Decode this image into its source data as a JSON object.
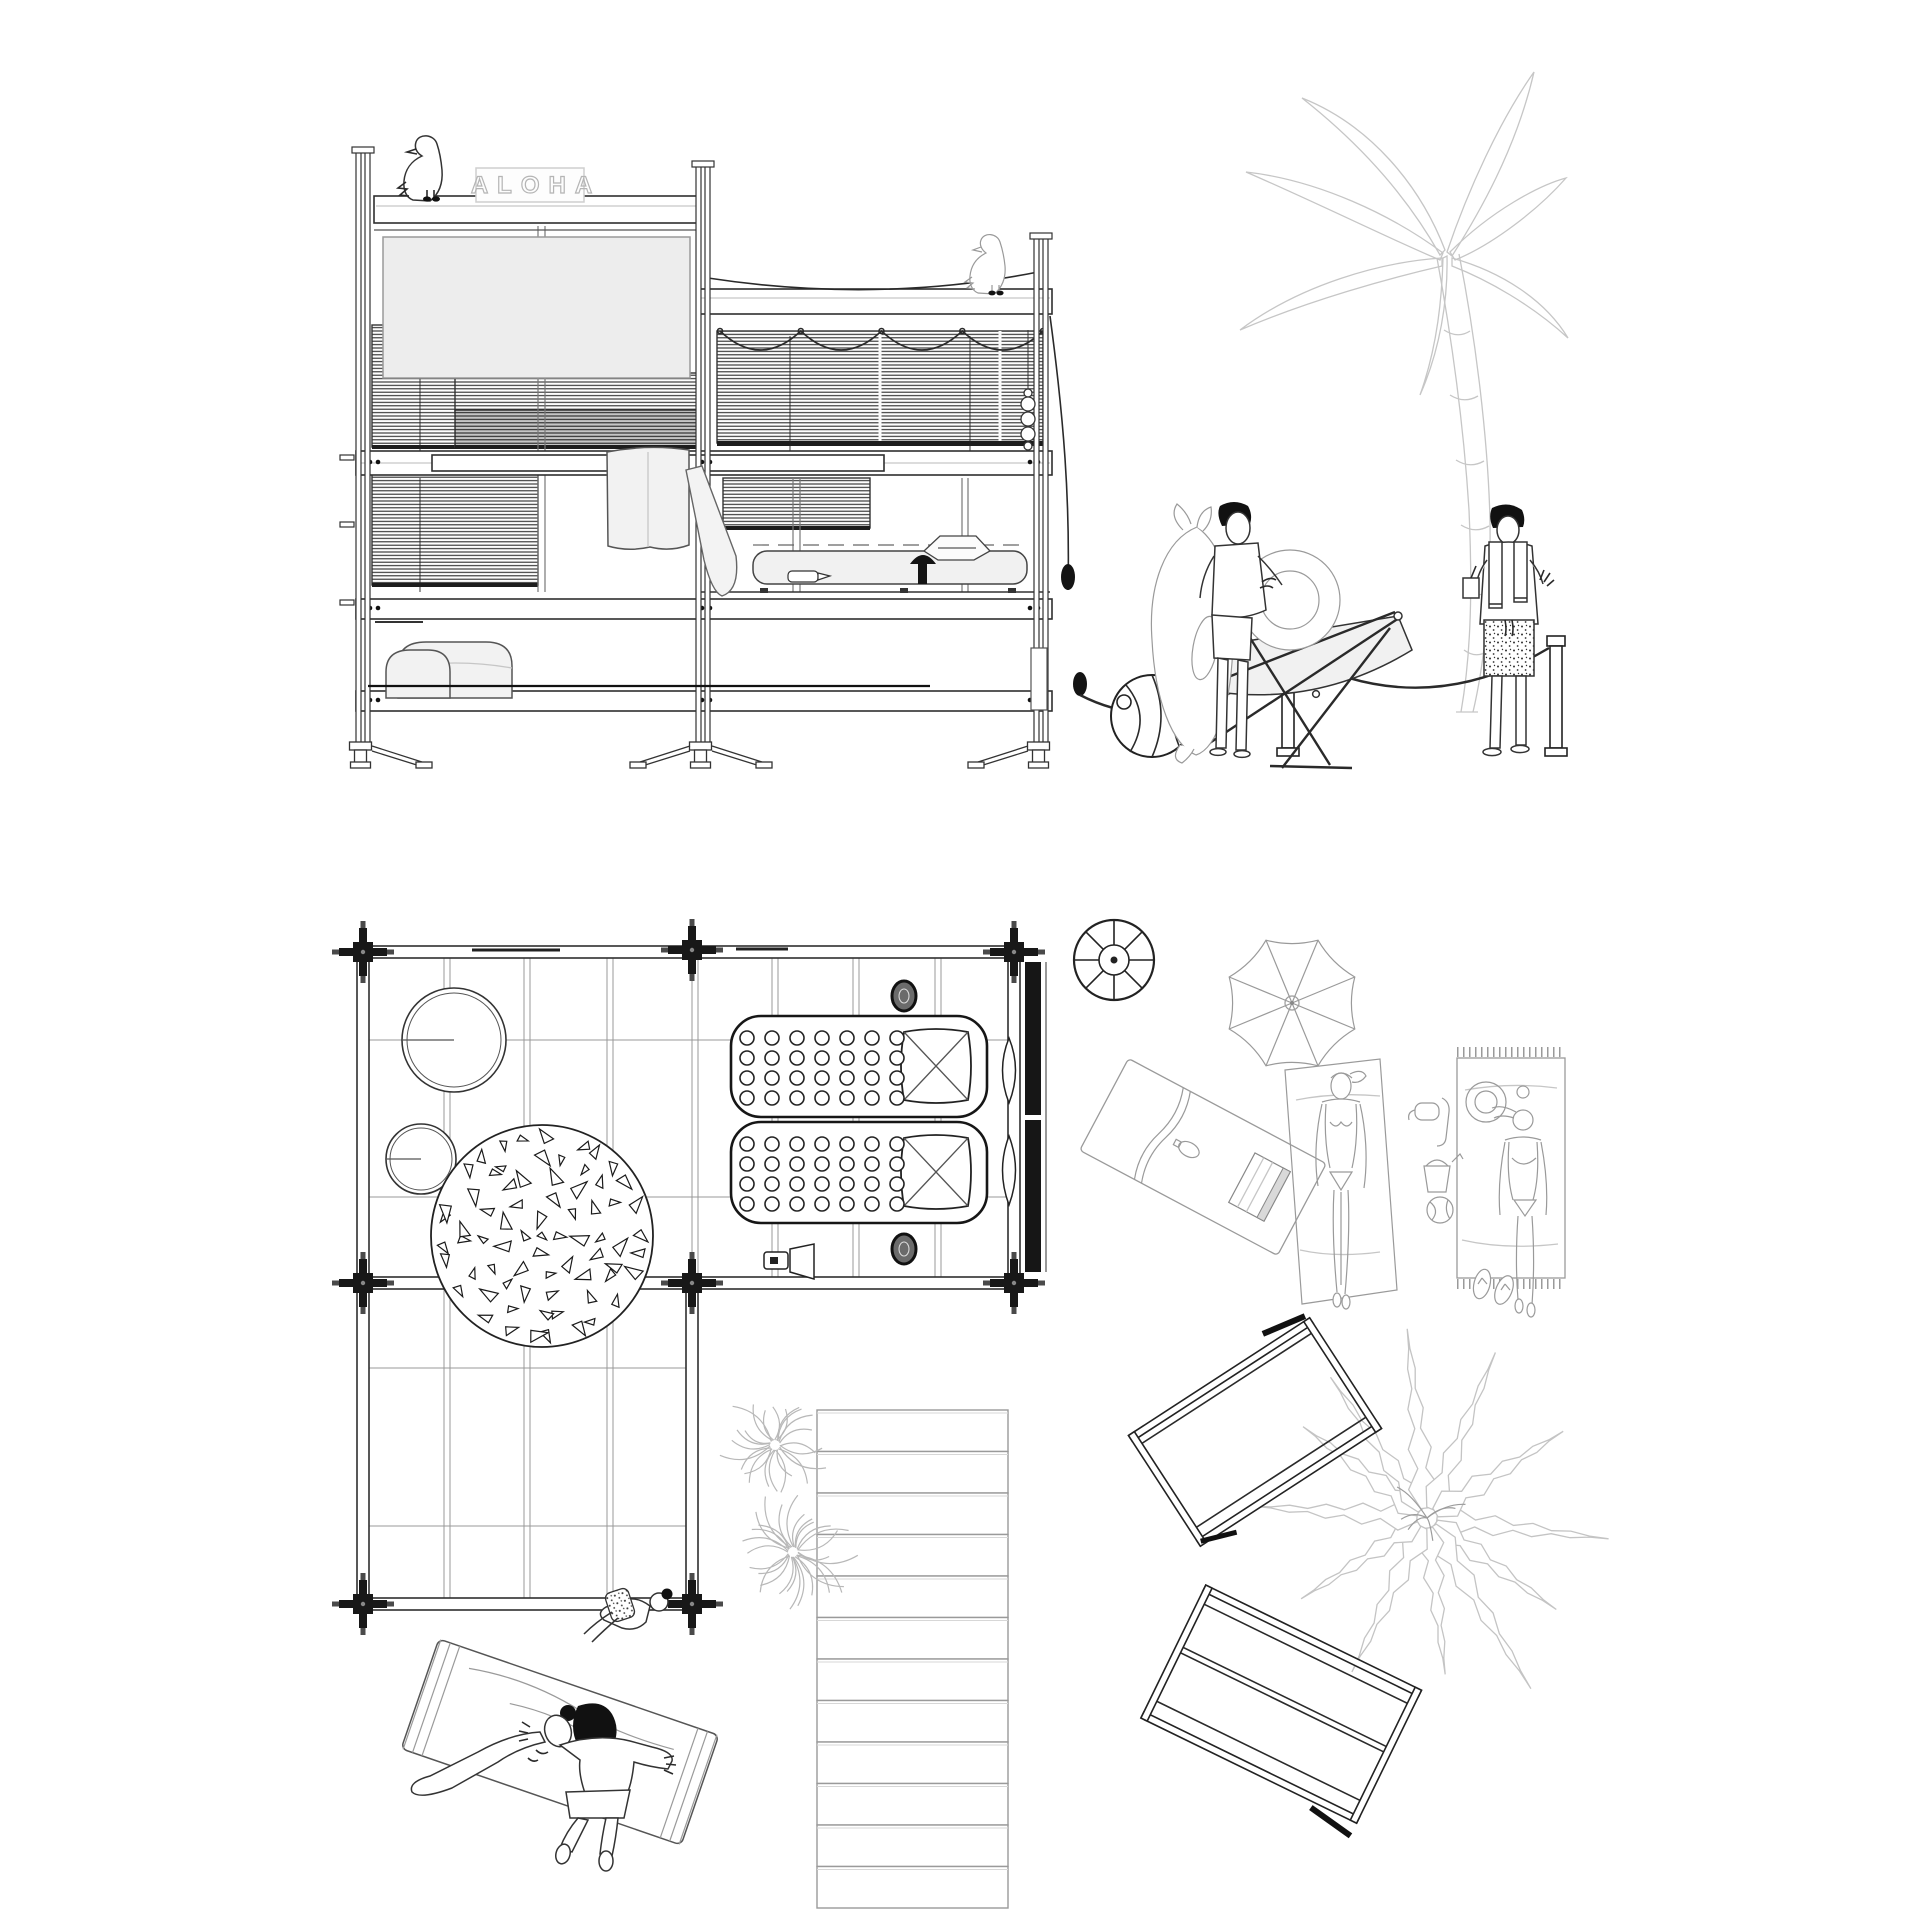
{
  "sign": {
    "text": "ALOHA"
  },
  "palette": {
    "ink": "#1f1f1f",
    "mid_line": "#555555",
    "light_line": "#9a9a9a",
    "faint_line": "#c6c6c6",
    "panel_fill": "#ededed",
    "soft_fill": "#f2f2f2",
    "dark_fill": "#141414",
    "paper": "#ffffff"
  },
  "plan": {
    "stairs_steps": 12,
    "mattresses": 2,
    "mattress_dots": {
      "rows": 4,
      "cols": 7
    },
    "rug_rings": [
      {
        "r": 99,
        "n": 25
      },
      {
        "r": 79,
        "n": 19
      },
      {
        "r": 59,
        "n": 14
      },
      {
        "r": 39,
        "n": 9
      },
      {
        "r": 17,
        "n": 4
      }
    ],
    "palm_top_fronds": 12,
    "plants": [
      {
        "x": 775,
        "y": 1445,
        "r": 58,
        "spikes": 24
      },
      {
        "x": 793,
        "y": 1552,
        "r": 66,
        "spikes": 28
      }
    ]
  }
}
